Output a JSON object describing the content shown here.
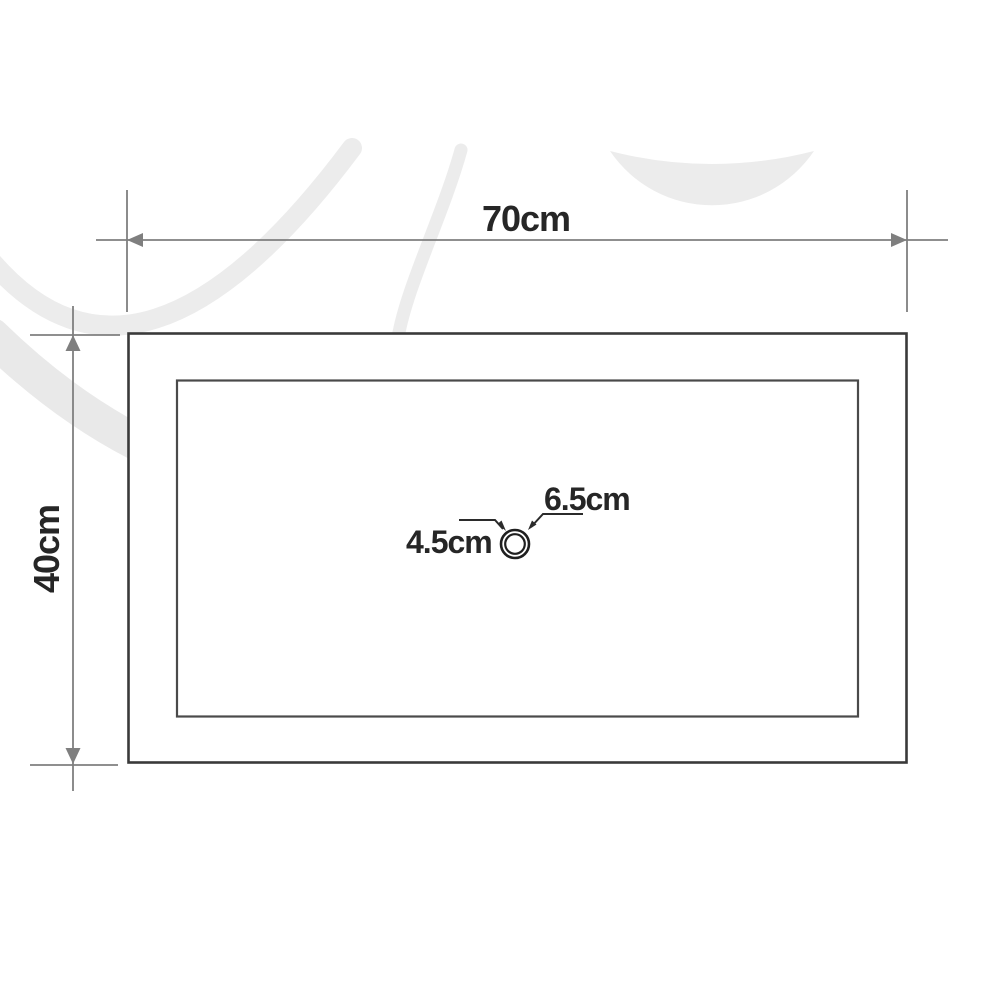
{
  "figure": {
    "type": "technical-dimension-drawing",
    "subject": "rectangular basin top view with drain hole",
    "labels": {
      "width": "70cm",
      "depth": "40cm",
      "drain_outer": "6.5cm",
      "drain_inner": "4.5cm"
    }
  },
  "colors": {
    "background": "#ffffff",
    "outline": "#3a3a3a",
    "inner_outline": "#4a4a4a",
    "dimension": "#7f7f7f",
    "leader": "#2b2b2b",
    "text": "#262626",
    "watermark": "#ececec"
  }
}
